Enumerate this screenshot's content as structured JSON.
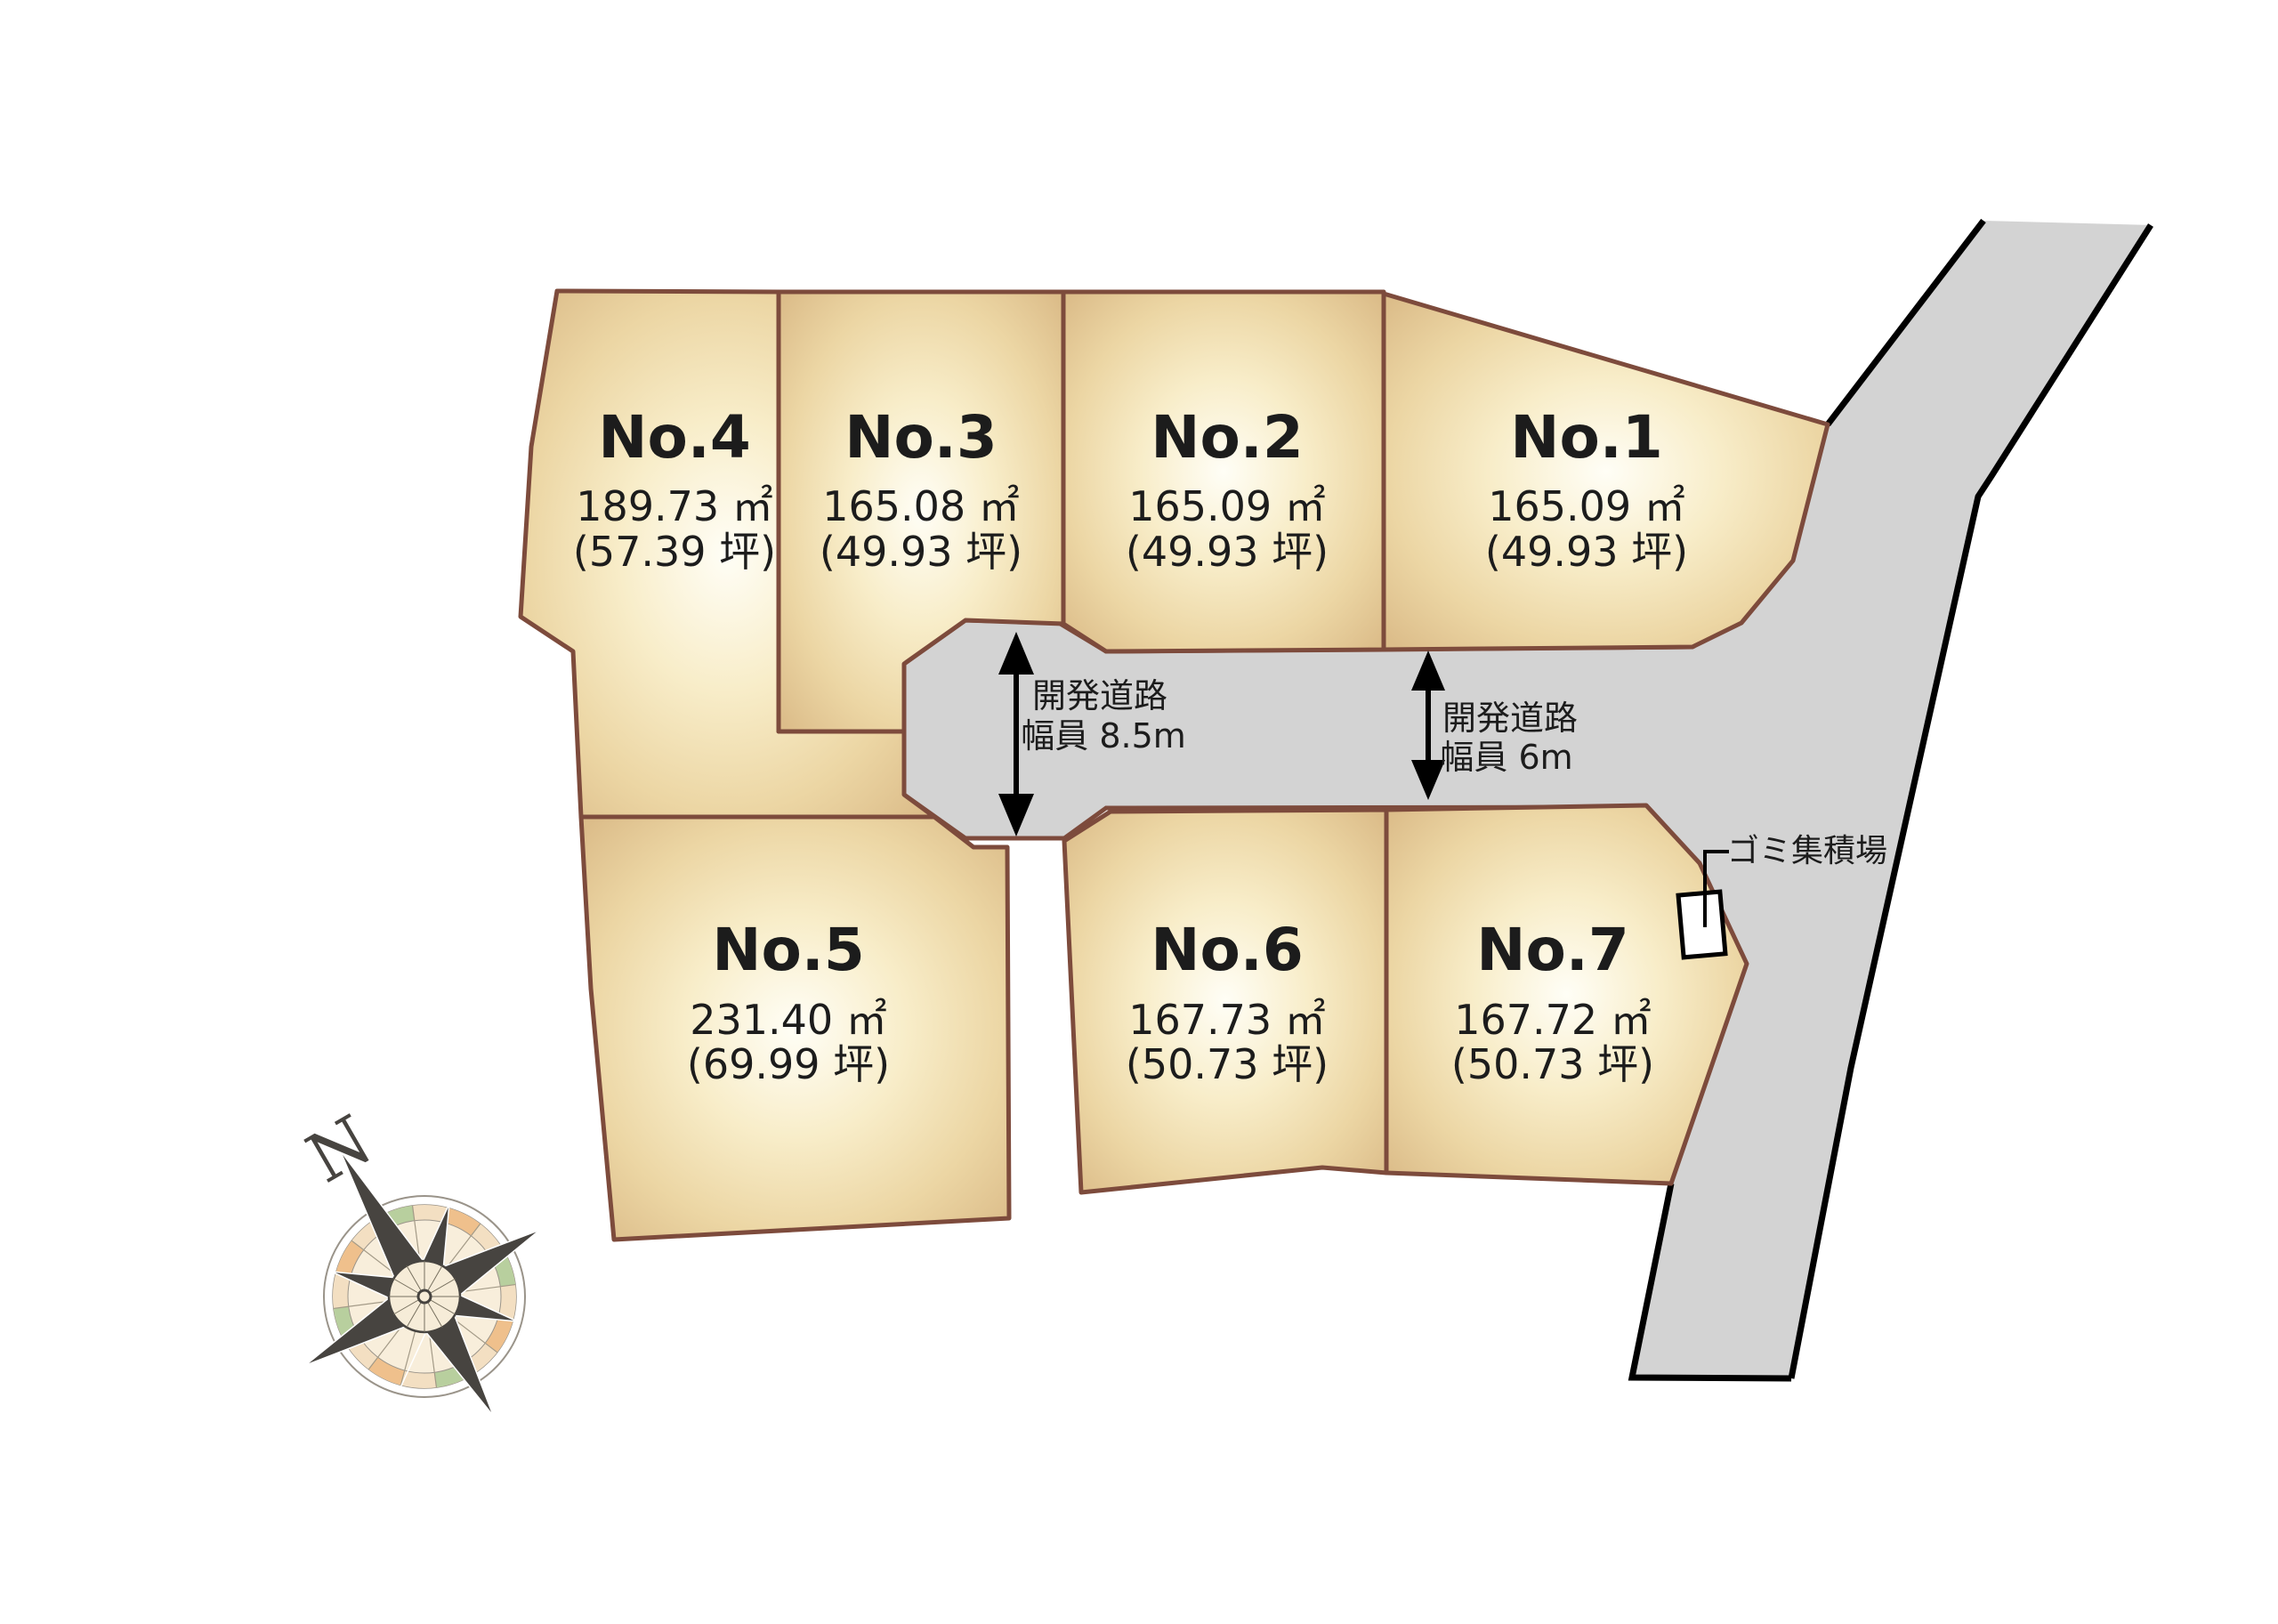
{
  "lots": [
    {
      "id": "no4",
      "name": "No.4",
      "area": "189.73 ㎡",
      "tsubo": "(57.39 坪)"
    },
    {
      "id": "no3",
      "name": "No.3",
      "area": "165.08 ㎡",
      "tsubo": "(49.93 坪)"
    },
    {
      "id": "no2",
      "name": "No.2",
      "area": "165.09 ㎡",
      "tsubo": "(49.93 坪)"
    },
    {
      "id": "no1",
      "name": "No.1",
      "area": "165.09 ㎡",
      "tsubo": "(49.93 坪)"
    },
    {
      "id": "no5",
      "name": "No.5",
      "area": "231.40 ㎡",
      "tsubo": "(69.99 坪)"
    },
    {
      "id": "no6",
      "name": "No.6",
      "area": "167.73 ㎡",
      "tsubo": "(50.73 坪)"
    },
    {
      "id": "no7",
      "name": "No.7",
      "area": "167.72 ㎡",
      "tsubo": "(50.73 坪)"
    }
  ],
  "roads": {
    "dev85": {
      "line1": "開発道路",
      "line2": "幅員 8.5m"
    },
    "dev6": {
      "line1": "開発道路",
      "line2": "幅員 6m"
    }
  },
  "annotations": {
    "garbage": "ゴミ集積場",
    "compass_north": "N"
  },
  "colors": {
    "lot_border": "#7d4b3c",
    "lot_fill_edge": "#dcbd8a",
    "road_fill": "#d3d3d3",
    "road_edge": "#000000"
  }
}
